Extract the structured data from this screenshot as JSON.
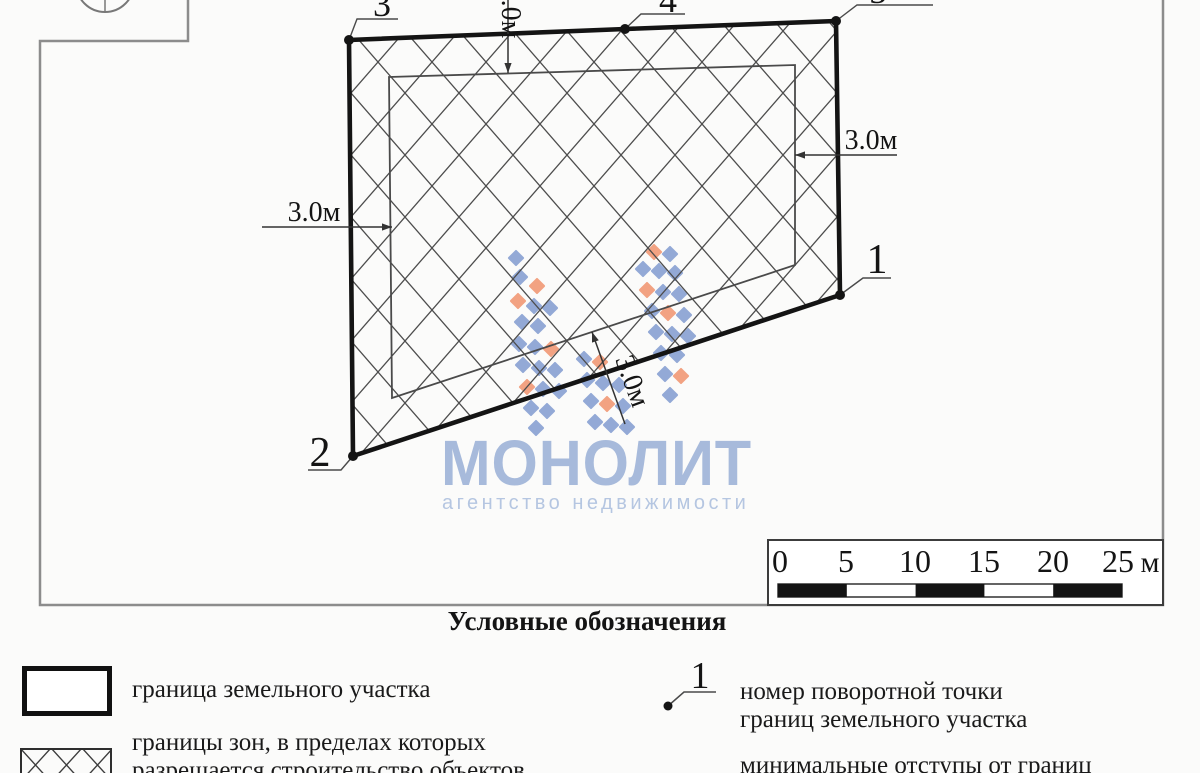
{
  "drawing": {
    "frame": {
      "path": [
        [
          188,
          0
        ],
        [
          188,
          41
        ],
        [
          40,
          41
        ],
        [
          40,
          605
        ],
        [
          1163,
          605
        ],
        [
          1163,
          0
        ]
      ]
    },
    "north_symbol": {
      "cx": 105,
      "cy": -17,
      "r": 29
    },
    "parcel_boundary": {
      "points": [
        [
          349,
          40
        ],
        [
          625,
          29
        ],
        [
          836,
          21
        ],
        [
          840,
          295
        ],
        [
          353,
          456
        ]
      ]
    },
    "buildable_zone": {
      "points": [
        [
          389,
          77
        ],
        [
          795,
          65
        ],
        [
          795,
          265
        ],
        [
          392,
          398
        ]
      ]
    },
    "vertex_labels": [
      {
        "text": "1",
        "dot": [
          840,
          295
        ],
        "leader": [
          [
            840,
            295
          ],
          [
            863,
            278
          ],
          [
            891,
            278
          ]
        ],
        "pos": [
          877,
          273
        ],
        "size": 42
      },
      {
        "text": "2",
        "dot": [
          353,
          456
        ],
        "leader": [
          [
            353,
            456
          ],
          [
            341,
            470
          ],
          [
            308,
            470
          ]
        ],
        "pos": [
          320,
          466
        ],
        "size": 42
      },
      {
        "text": "3",
        "dot": [
          349,
          40
        ],
        "leader": [
          [
            349,
            40
          ],
          [
            357,
            19
          ],
          [
            398,
            19
          ]
        ],
        "pos": [
          382,
          16
        ],
        "size": 36
      },
      {
        "text": "4",
        "dot": [
          625,
          29
        ],
        "leader": [
          [
            625,
            29
          ],
          [
            641,
            14
          ],
          [
            685,
            14
          ]
        ],
        "pos": [
          668,
          12
        ],
        "size": 36
      },
      {
        "text": "5",
        "dot": [
          836,
          21
        ],
        "leader": [
          [
            836,
            21
          ],
          [
            857,
            5
          ],
          [
            933,
            5
          ]
        ],
        "pos": [
          878,
          3
        ],
        "size": 36
      }
    ],
    "setback_dimensions": [
      {
        "text": "3.0м",
        "line": [
          [
            508,
            -10
          ],
          [
            508,
            73
          ]
        ],
        "text_pos": [
          502,
          12
        ],
        "rotate": 90
      },
      {
        "text": "3.0м",
        "line": [
          [
            897,
            155
          ],
          [
            795,
            155
          ]
        ],
        "text_pos": [
          871,
          149
        ],
        "rotate": 0
      },
      {
        "text": "3.0м",
        "line": [
          [
            262,
            227
          ],
          [
            392,
            227
          ]
        ],
        "text_pos": [
          314,
          221
        ],
        "rotate": 0
      },
      {
        "text": "3.0м",
        "line": [
          [
            625,
            424
          ],
          [
            592,
            332
          ]
        ],
        "text_pos": [
          624,
          384
        ],
        "rotate": 70
      }
    ],
    "scale_bar": {
      "box": [
        768,
        540,
        395,
        65
      ],
      "labels": [
        "0",
        "5",
        "10",
        "15",
        "20",
        "25"
      ],
      "label_x": [
        780,
        846,
        915,
        984,
        1053,
        1118
      ],
      "label_y": 572,
      "unit": "м",
      "unit_x": 1150,
      "bar": {
        "x": 778,
        "y": 584,
        "w": 344,
        "h": 13,
        "segments": 5,
        "filled": [
          0,
          2,
          4
        ]
      }
    }
  },
  "watermark": {
    "title": "МОНОЛИТ",
    "subtitle": "агентство недвижимости",
    "title_color": "#a7badb",
    "subtitle_color": "#b5c6e1",
    "logo_colors": {
      "b": "#93a9d6",
      "o": "#f2a282"
    },
    "squares": [
      [
        516,
        258,
        "b"
      ],
      [
        520,
        277,
        "b"
      ],
      [
        537,
        286,
        "o"
      ],
      [
        518,
        301,
        "o"
      ],
      [
        534,
        306,
        "b"
      ],
      [
        550,
        308,
        "b"
      ],
      [
        522,
        322,
        "b"
      ],
      [
        538,
        326,
        "b"
      ],
      [
        519,
        344,
        "b"
      ],
      [
        535,
        347,
        "b"
      ],
      [
        551,
        349,
        "o"
      ],
      [
        523,
        365,
        "b"
      ],
      [
        539,
        368,
        "b"
      ],
      [
        555,
        370,
        "b"
      ],
      [
        527,
        387,
        "o"
      ],
      [
        543,
        389,
        "b"
      ],
      [
        559,
        391,
        "b"
      ],
      [
        531,
        408,
        "b"
      ],
      [
        547,
        411,
        "b"
      ],
      [
        536,
        428,
        "b"
      ],
      [
        584,
        359,
        "b"
      ],
      [
        600,
        362,
        "o"
      ],
      [
        587,
        380,
        "b"
      ],
      [
        603,
        383,
        "b"
      ],
      [
        619,
        385,
        "b"
      ],
      [
        591,
        401,
        "b"
      ],
      [
        607,
        404,
        "o"
      ],
      [
        623,
        406,
        "b"
      ],
      [
        595,
        422,
        "b"
      ],
      [
        611,
        425,
        "b"
      ],
      [
        627,
        427,
        "b"
      ],
      [
        654,
        252,
        "o"
      ],
      [
        670,
        254,
        "b"
      ],
      [
        643,
        269,
        "b"
      ],
      [
        659,
        271,
        "b"
      ],
      [
        675,
        273,
        "b"
      ],
      [
        647,
        290,
        "o"
      ],
      [
        663,
        292,
        "b"
      ],
      [
        679,
        294,
        "b"
      ],
      [
        652,
        311,
        "b"
      ],
      [
        668,
        313,
        "o"
      ],
      [
        684,
        315,
        "b"
      ],
      [
        656,
        332,
        "b"
      ],
      [
        672,
        334,
        "b"
      ],
      [
        688,
        336,
        "b"
      ],
      [
        661,
        353,
        "b"
      ],
      [
        677,
        355,
        "b"
      ],
      [
        665,
        374,
        "b"
      ],
      [
        681,
        376,
        "o"
      ],
      [
        670,
        395,
        "b"
      ]
    ]
  },
  "legend": {
    "title": "Условные обозначения",
    "items": [
      {
        "symbol": "boundary-rect",
        "line1": "граница земельного участка",
        "line2": ""
      },
      {
        "symbol": "hatched-rect",
        "line1": "границы зон, в пределах которых",
        "line2": "разрешается строительство объектов"
      },
      {
        "symbol": "vertex-point",
        "symbol_label": "1",
        "line1": "номер поворотной точки",
        "line2": "границ земельного участка"
      },
      {
        "symbol": "none",
        "line1": "минимальные отступы от границ",
        "line2": ""
      }
    ]
  }
}
